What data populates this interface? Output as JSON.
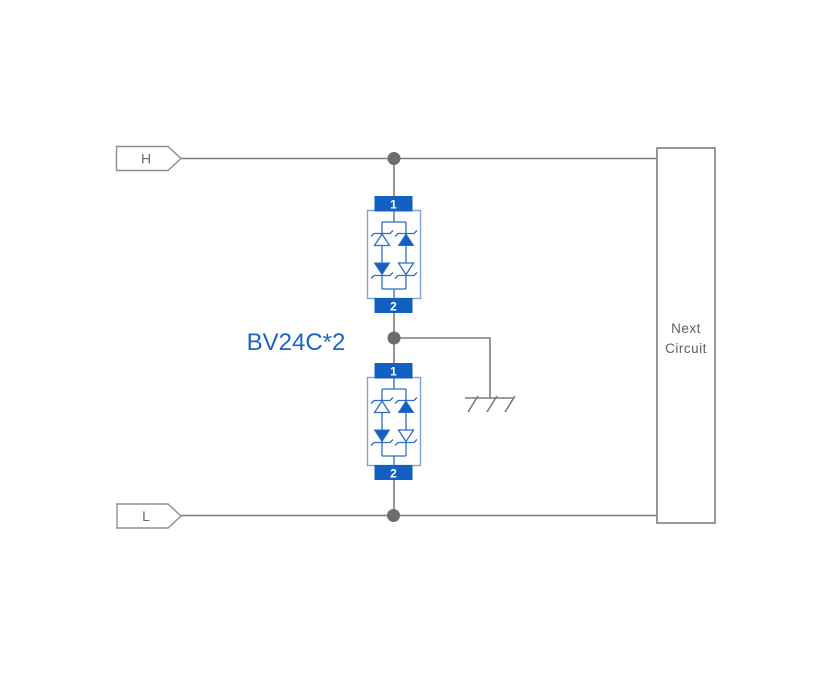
{
  "terminals": {
    "high": "H",
    "low": "L"
  },
  "module": {
    "pin_top": "1",
    "pin_bottom": "2"
  },
  "label": {
    "text": "BV24C*2"
  },
  "next_circuit": {
    "line1": "Next",
    "line2": "Circuit"
  },
  "colors": {
    "component_blue": "#1160c2",
    "diode_outline_blue": "#2e6ec6",
    "module_box_blue": "#7ba4da",
    "label_blue": "#1b66c8",
    "wire_gray": "#7d7d7d",
    "dot_gray": "#6d6d6d",
    "text_gray": "#6a6a6a",
    "background": "#ffffff"
  }
}
